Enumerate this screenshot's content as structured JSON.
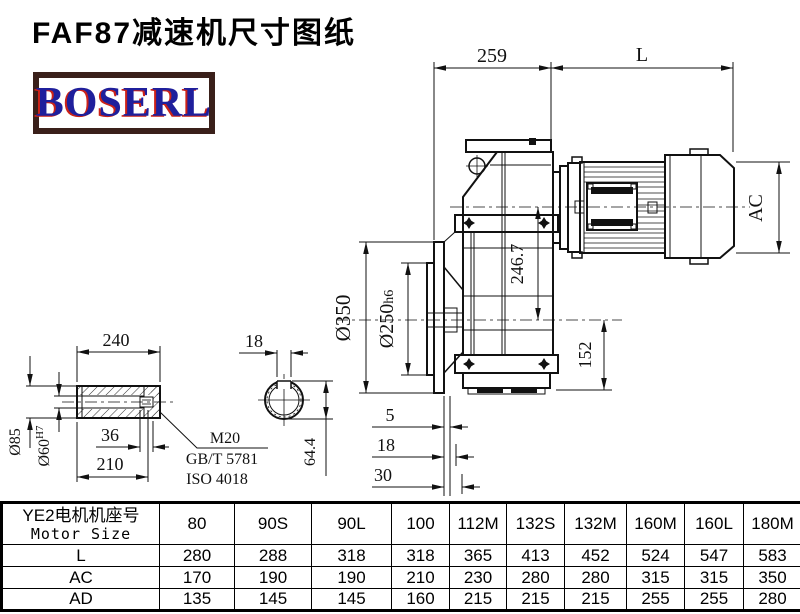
{
  "title": "FAF87减速机尺寸图纸",
  "logo": {
    "text": "BOSERL"
  },
  "colors": {
    "logo_border": "#3a201a",
    "logo_text": "#1f1f9c",
    "logo_shadow": "#cc2218",
    "line": "#111111"
  },
  "drawing": {
    "main": {
      "d259": "259",
      "dL": "L",
      "dAC": "AC",
      "d350": "Ø350",
      "d250": "Ø250",
      "d250_fit": "h6",
      "d2467": "246.7",
      "d152": "152",
      "d5": "5",
      "d18": "18",
      "d30": "30"
    },
    "shaft": {
      "d240": "240",
      "d36": "36",
      "d210": "210",
      "d85": "Ø85",
      "d60": "Ø60",
      "d60_fit": "H7",
      "thread": "M20",
      "std_gb": "GB/T 5781",
      "std_iso": "ISO 4018"
    },
    "key": {
      "d18": "18",
      "d644": "64.4"
    }
  },
  "table": {
    "motor_label_cn": "YE2电机机座号",
    "motor_label_en": "Motor Size",
    "columns": [
      "80",
      "90S",
      "90L",
      "100",
      "112M",
      "132S",
      "132M",
      "160M",
      "160L",
      "180M",
      "180L"
    ],
    "rows": [
      {
        "label": "L",
        "values": [
          "280",
          "288",
          "318",
          "318",
          "365",
          "413",
          "452",
          "524",
          "547",
          "583",
          "616"
        ]
      },
      {
        "label": "AC",
        "values": [
          "170",
          "190",
          "190",
          "210",
          "230",
          "280",
          "280",
          "315",
          "315",
          "350",
          "350"
        ]
      },
      {
        "label": "AD",
        "values": [
          "135",
          "145",
          "145",
          "160",
          "215",
          "215",
          "215",
          "255",
          "255",
          "280",
          "280"
        ]
      }
    ]
  }
}
